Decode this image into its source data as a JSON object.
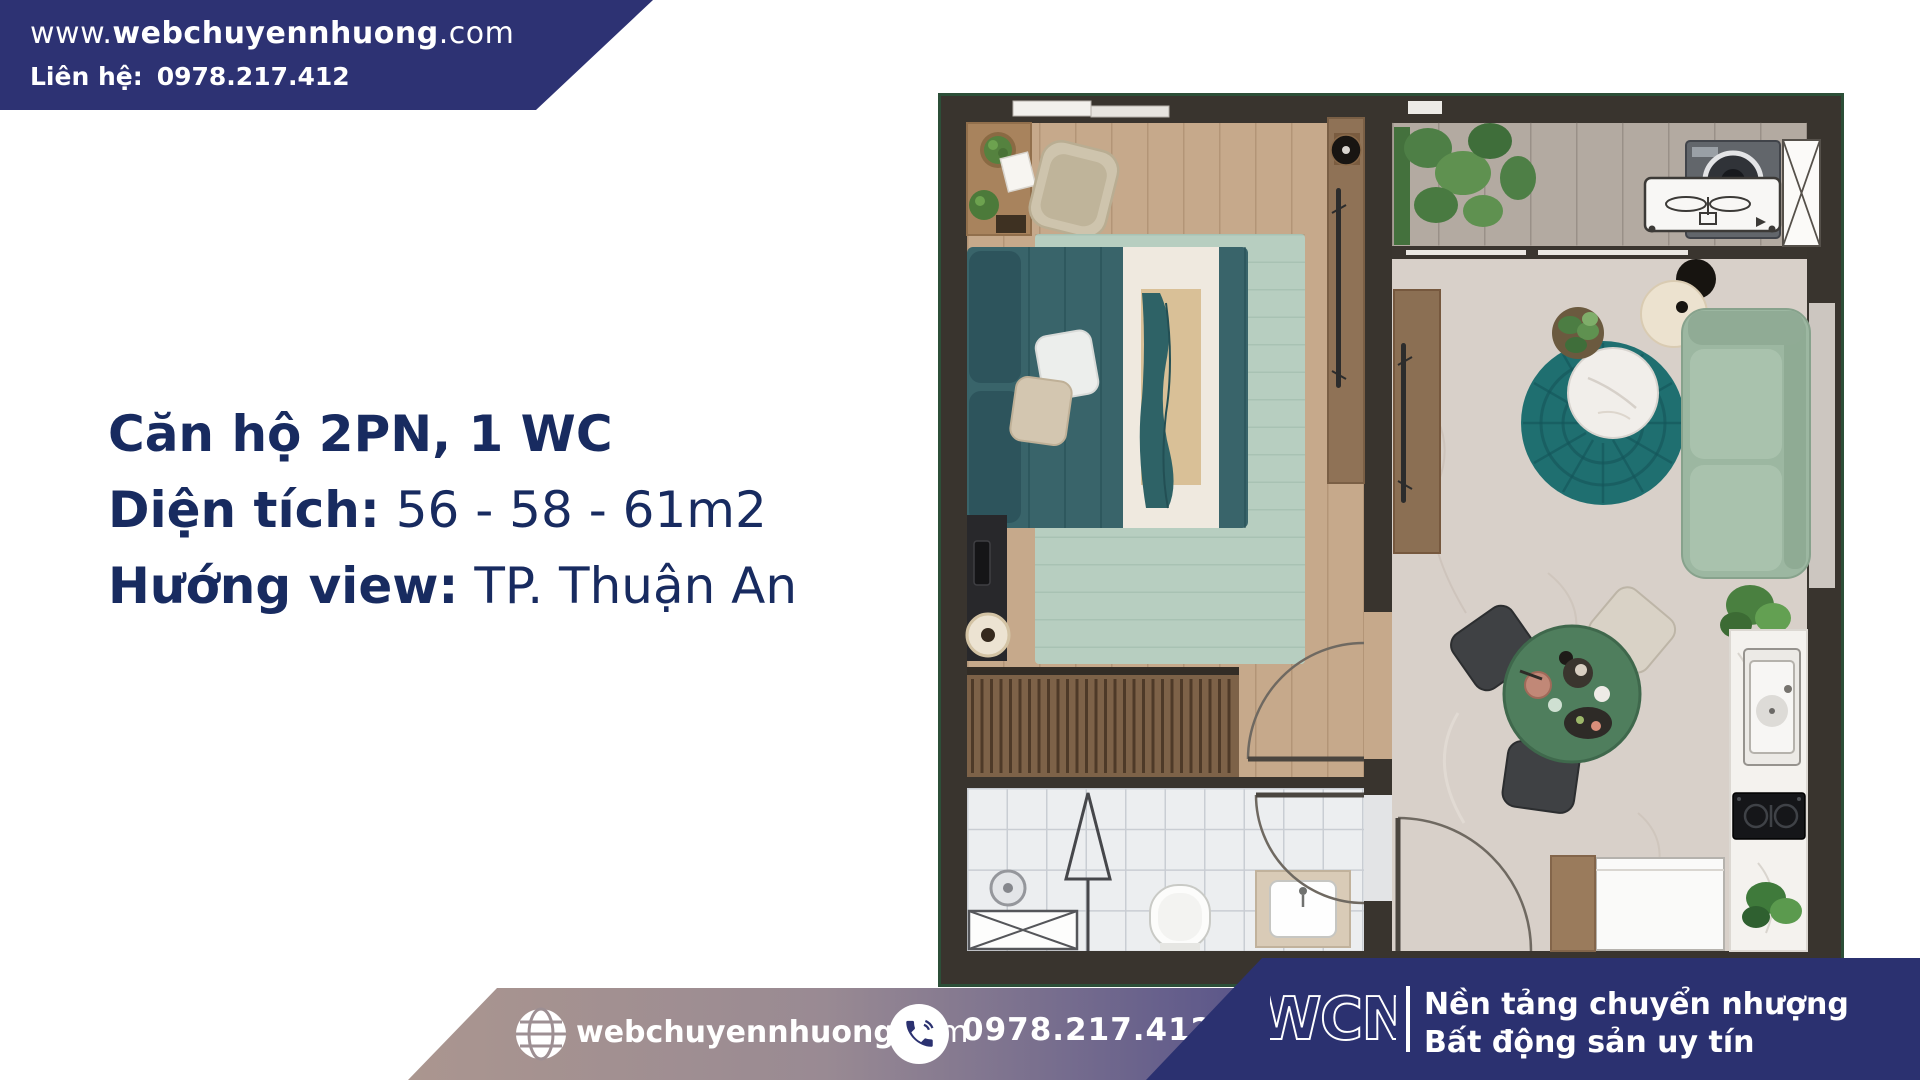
{
  "banner": {
    "url_prefix": "www.",
    "url_bold": "webchuyennhuong",
    "url_suffix": ".com",
    "contact_label": "Liên hệ:",
    "phone": "0978.217.412"
  },
  "listing": {
    "title": "Căn hộ 2PN, 1 WC",
    "area_label": "Diện tích:",
    "area_value": "56 - 58 - 61m2",
    "view_label": "Hướng view:",
    "view_value": "TP. Thuận An"
  },
  "footer": {
    "site_bold": "webchuyennhuong",
    "site_suffix": ".com",
    "phone": "0978.217.412",
    "logo": "WCN",
    "tagline_line1": "Nền tảng chuyển nhượng",
    "tagline_line2": "Bất động sản uy tín"
  },
  "floor_plan": {
    "description": "Top-down render of an apartment floor plan: bedroom with teal bed, wooden deck, tiled bathroom, balcony with washer and plants, living-dining room with teal round rug, green sofa, green dining table and kitchen counter"
  },
  "colors": {
    "navy": "#2d3273",
    "footer_navy": "#2b3170",
    "text_navy": "#182b60",
    "footer_gradient_left": "#ab968f",
    "plan_border_green": "#2c4f38",
    "teal_rug": "#1f6f70",
    "bed_teal": "#39646a",
    "sofa_sage": "#9cb7a1",
    "dining_green": "#4f7e5d"
  }
}
